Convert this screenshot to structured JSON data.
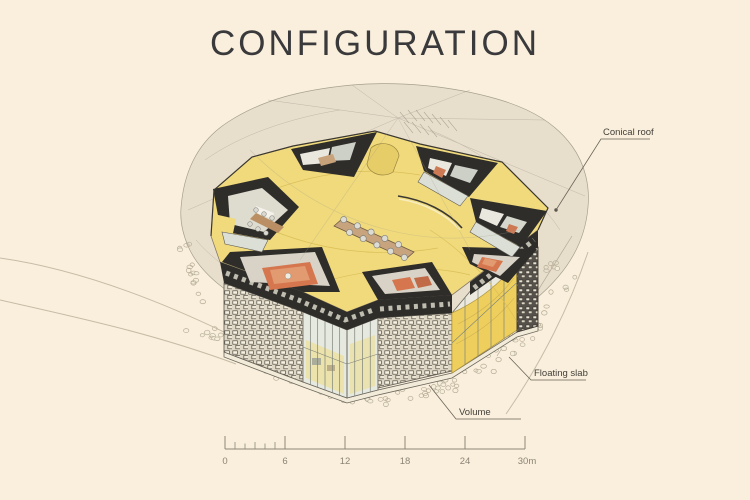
{
  "title": "CONFIGURATION",
  "annotations": {
    "conical_roof": {
      "label": "Conical roof"
    },
    "floating_slab": {
      "label": "Floating slab"
    },
    "volume": {
      "label": "Volume"
    }
  },
  "scale_bar": {
    "labels": [
      "0",
      "6",
      "12",
      "18",
      "24",
      "30m"
    ],
    "start_m": 0,
    "end_m": 30,
    "major_interval_m": 6,
    "minor_interval_m": 1
  },
  "colors": {
    "background": "#f9efdc",
    "floor_yellow": "#f0da7c",
    "ramp_yellow": "#eecf5e",
    "wall_dark": "#2f2d2a",
    "accent_orange": "#d5764e",
    "ghost_roof_gray": "#c6bfae",
    "stipple": "#b6ad97",
    "label_text": "#44403a",
    "scale_text": "#8d8476"
  }
}
